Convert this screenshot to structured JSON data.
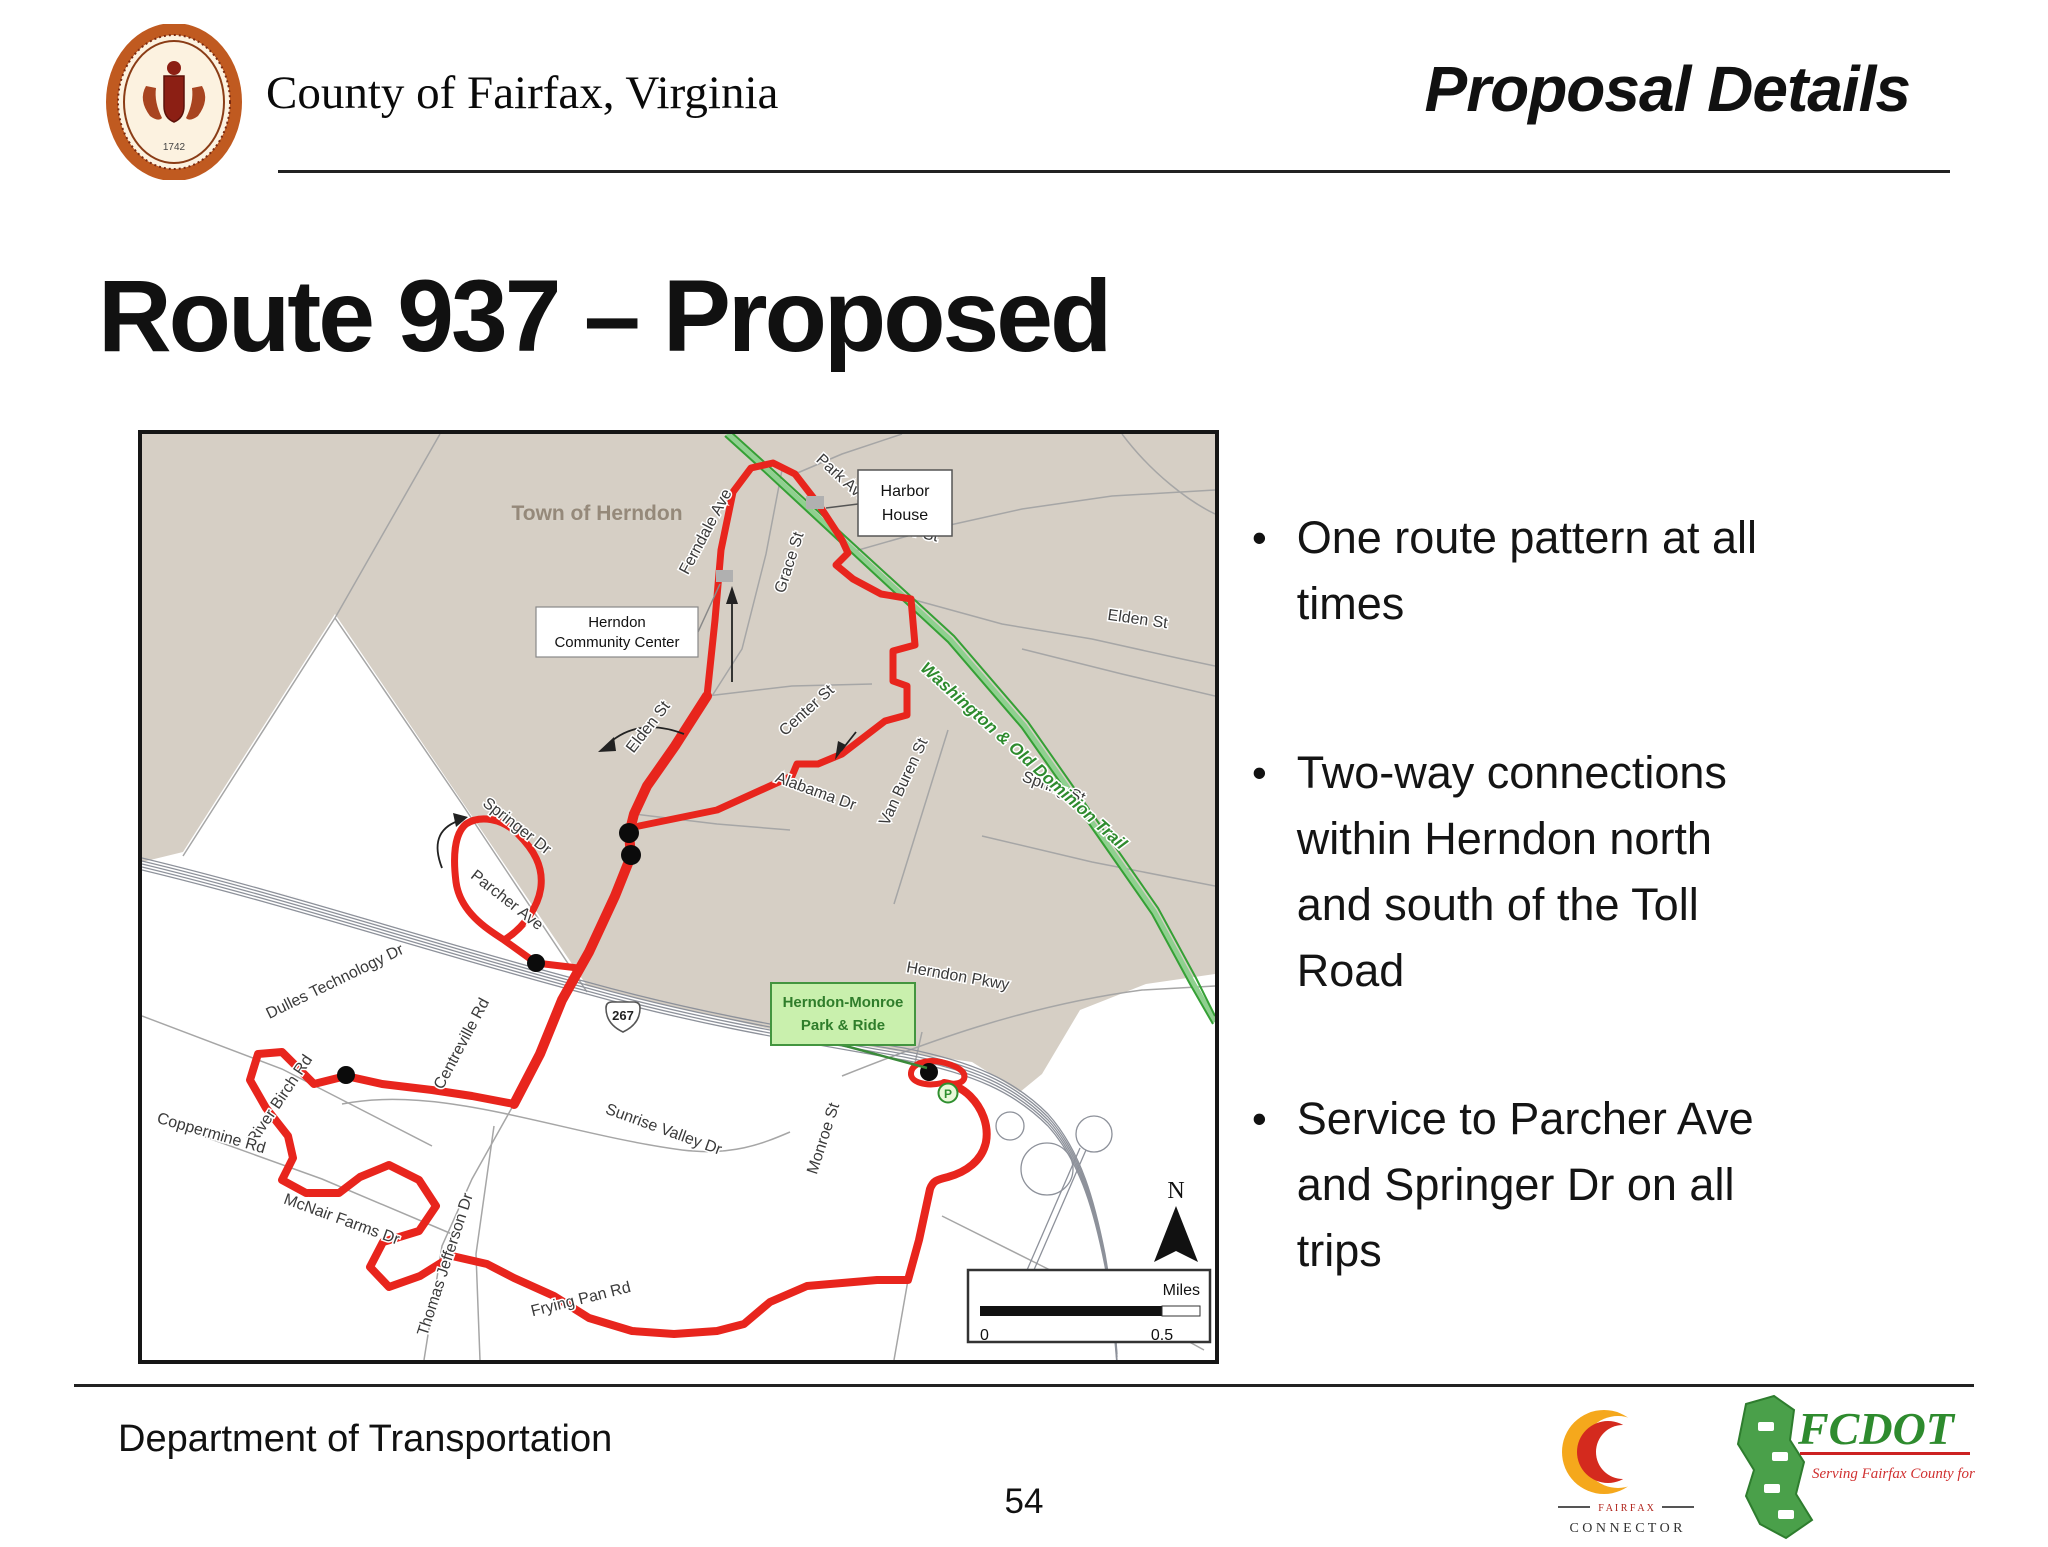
{
  "header": {
    "agency": "County of Fairfax, Virginia",
    "page_title": "Proposal Details"
  },
  "slide_title": "Route 937 – Proposed",
  "seal": {
    "year": "1742"
  },
  "map": {
    "town_label": "Town of Herndon",
    "trail_label": "Washington & Old Dominion Trail",
    "streets": {
      "park_ave": "Park Ave",
      "ferndale_ave": "Ferndale Ave",
      "grace_st": "Grace St",
      "center_st_n": "Center St",
      "center_st_s": "Center St",
      "elden_st_w": "Elden St",
      "elden_st_e": "Elden St",
      "alabama_dr": "Alabama Dr",
      "van_buren_st": "Van Buren St",
      "spring_st": "Spring St",
      "herndon_pkwy": "Herndon Pkwy",
      "springer_dr": "Springer Dr",
      "parcher_ave": "Parcher Ave",
      "dulles_technology_dr": "Dulles Technology Dr",
      "centreville_rd": "Centreville  Rd",
      "river_birch_rd": "River Birch Rd",
      "coppermine_rd": "Coppermine Rd",
      "mcnair_farms_dr": "McNair Farms Dr",
      "thomas_jefferson_dr": "Thomas Jefferson Dr",
      "frying_pan_rd": "Frying Pan Rd",
      "sunrise_valley_dr": "Sunrise Valley Dr",
      "monroe_st": "Monroe St",
      "fox_mill_rd": "Fox Mill Rd"
    },
    "callouts": {
      "harbor_house_line1": "Harbor",
      "harbor_house_line2": "House",
      "community_center_line1": "Herndon",
      "community_center_line2": "Community Center",
      "park_ride_line1": "Herndon-Monroe",
      "park_ride_line2": "Park & Ride"
    },
    "shield_267": "267",
    "parking_symbol": "P",
    "north_label": "N",
    "scale_title": "Miles",
    "scale_start": "0",
    "scale_end": "0.5",
    "colors": {
      "route_red": "#e8251d",
      "trail_green": "#35a035",
      "town_beige": "#d6cfc5",
      "park_ride_green": "#c9f0ad"
    }
  },
  "bullets": [
    {
      "marker": "•",
      "text": "One route pattern at all\ntimes"
    },
    {
      "marker": "•",
      "text": "Two-way connections\nwithin Herndon north\nand south of the Toll\nRoad"
    },
    {
      "marker": "•",
      "text": "Service to Parcher Ave\nand Springer Dr on all\ntrips"
    }
  ],
  "footer": {
    "department": "Department of Transportation",
    "page_number": "54",
    "connector": {
      "top": "F A I R F A X",
      "bottom": "C O N N E C T O R"
    },
    "fcdot": {
      "name": "FCDOT",
      "tagline": "Serving Fairfax County\nfor 30 Years and More"
    }
  }
}
